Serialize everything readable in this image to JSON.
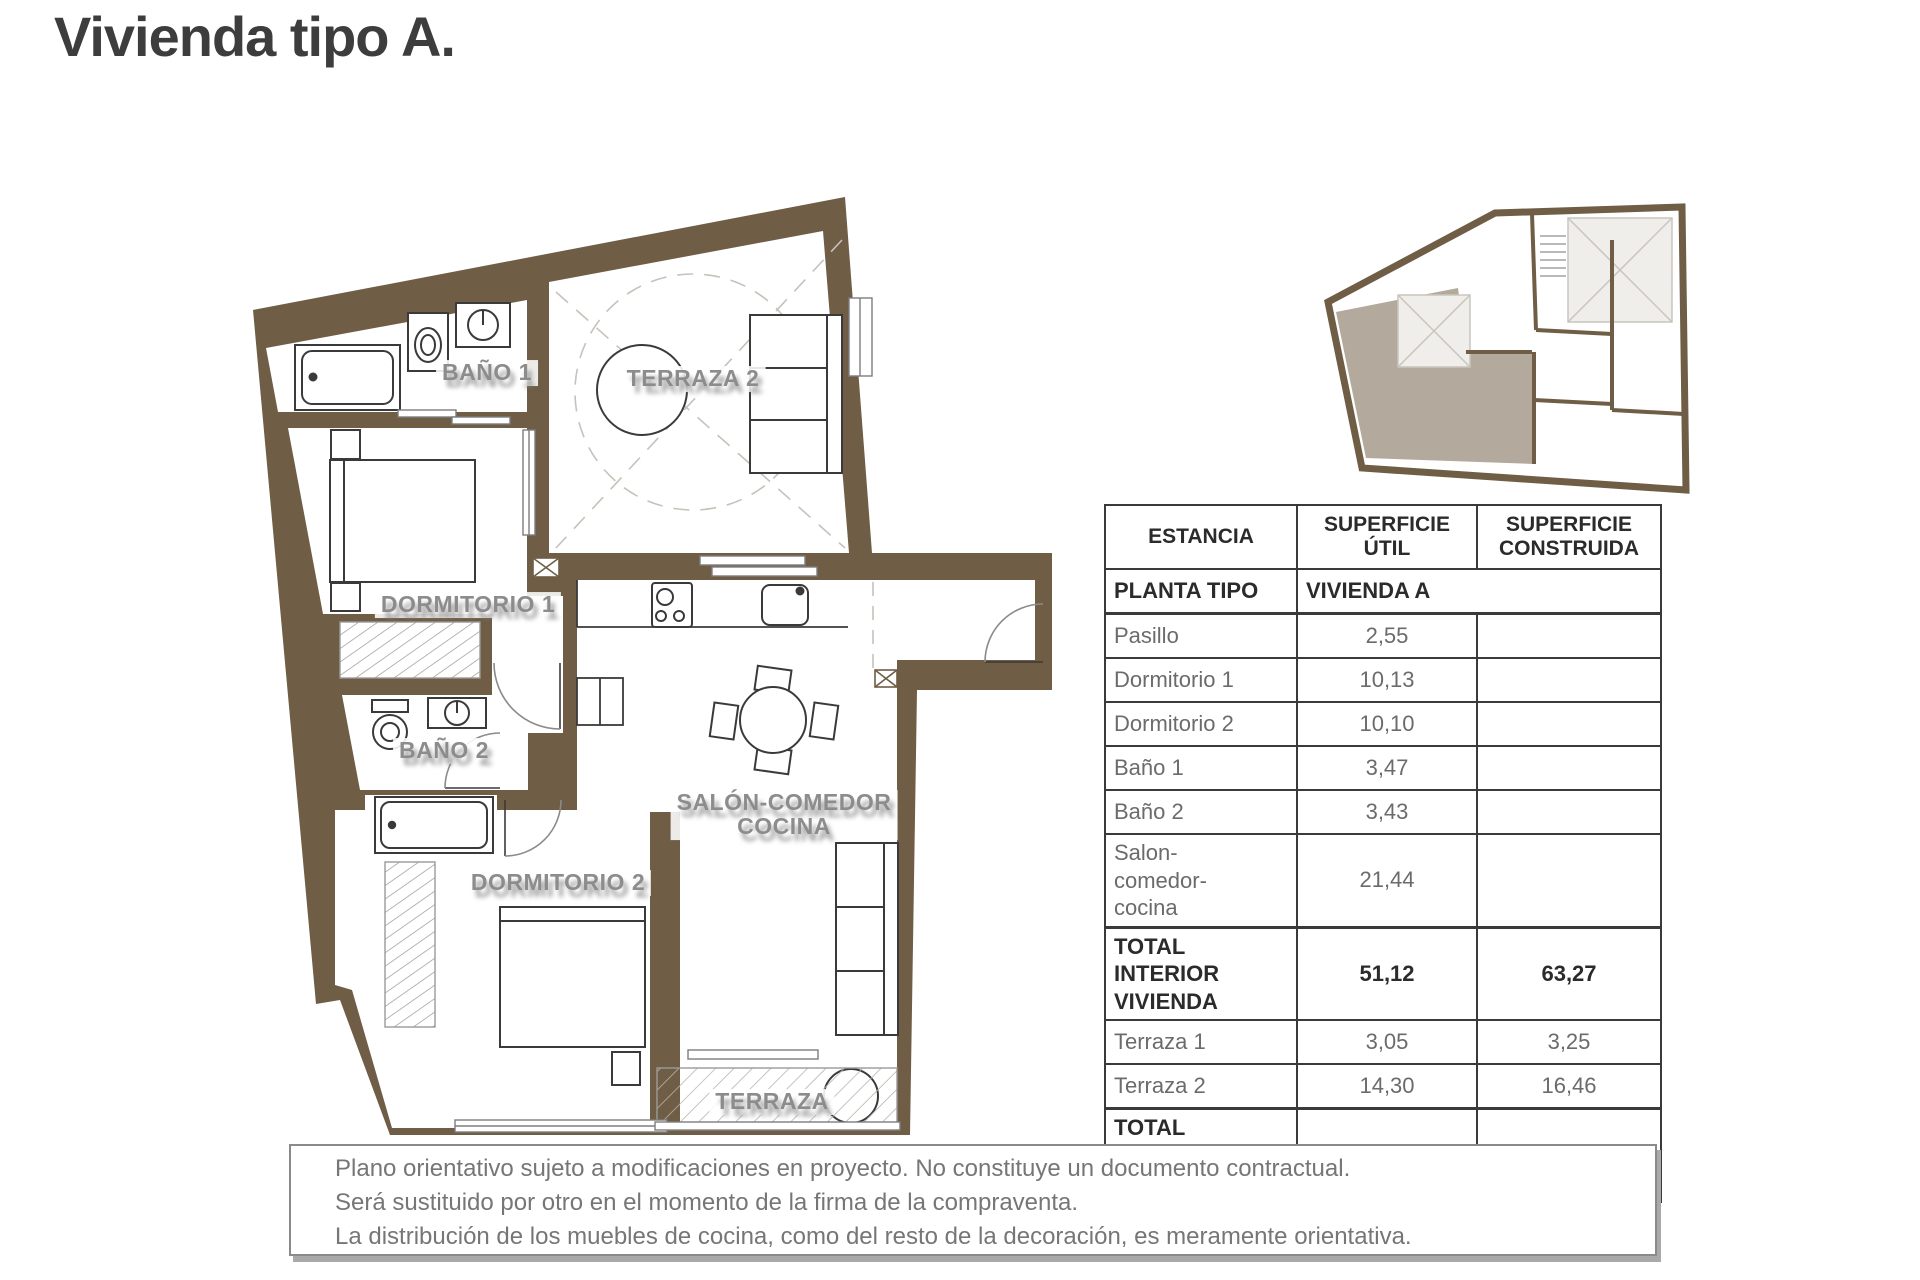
{
  "title": "Vivienda tipo A.",
  "floor_plan": {
    "rooms": {
      "terraza2": "TERRAZA 2",
      "bano1": "BAÑO 1",
      "dormitorio1": "DORMITORIO 1",
      "bano2": "BAÑO 2",
      "salon_line1": "SALÓN-COMEDOR",
      "salon_line2": "COCINA",
      "dormitorio2": "DORMITORIO 2",
      "terraza": "TERRAZA"
    }
  },
  "colors": {
    "wall_brown": "#6f5d45",
    "unit_highlight": "#b3a99d",
    "label_gray": "#8c8c8c",
    "title_gray": "#3d3d3d"
  },
  "table": {
    "header": {
      "estancia": "ESTANCIA",
      "util": "SUPERFICIE ÚTIL",
      "construida": "SUPERFICIE CONSTRUIDA"
    },
    "subrow": {
      "label": "PLANTA TIPO",
      "value": "VIVIENDA A"
    },
    "rows": [
      {
        "estancia": "Pasillo",
        "util": "2,55",
        "construida": "",
        "bold": false
      },
      {
        "estancia": "Dormitorio 1",
        "util": "10,13",
        "construida": "",
        "bold": false
      },
      {
        "estancia": "Dormitorio 2",
        "util": "10,10",
        "construida": "",
        "bold": false
      },
      {
        "estancia": "Baño 1",
        "util": "3,47",
        "construida": "",
        "bold": false
      },
      {
        "estancia": "Baño 2",
        "util": "3,43",
        "construida": "",
        "bold": false
      },
      {
        "estancia": "Salon-\ncomedor-\ncocina",
        "util": "21,44",
        "construida": "",
        "bold": false
      },
      {
        "estancia": "TOTAL INTERIOR\nVIVIENDA",
        "util": "51,12",
        "construida": "63,27",
        "bold": true
      },
      {
        "estancia": "Terraza 1",
        "util": "3,05",
        "construida": "3,25",
        "bold": false
      },
      {
        "estancia": "Terraza 2",
        "util": "14,30",
        "construida": "16,46",
        "bold": false
      },
      {
        "estancia": "TOTAL VIVIENDA\n+ TERRAZAS",
        "util": "65,84",
        "construida": "78,55",
        "bold": true
      }
    ]
  },
  "disclaimer": {
    "lines": [
      "Plano orientativo sujeto a modificaciones en proyecto. No constituye un documento contractual.",
      "Será sustituido por otro en el momento de la firma de la compraventa.",
      "La distribución de los muebles de cocina, como del resto de la decoración, es meramente orientativa."
    ]
  }
}
